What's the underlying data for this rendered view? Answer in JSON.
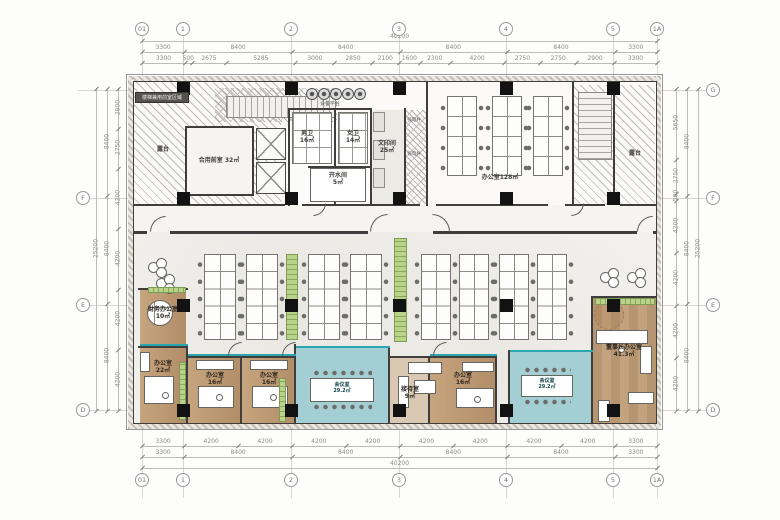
{
  "grid": {
    "top_labels": [
      "01",
      "1",
      "2",
      "3",
      "4",
      "5",
      "1A"
    ],
    "bottom_labels": [
      "01",
      "1",
      "2",
      "3",
      "4",
      "5",
      "1A"
    ],
    "left_labels": [
      "F",
      "E",
      "D"
    ],
    "right_labels": [
      "G",
      "F",
      "E",
      "D"
    ]
  },
  "dims": {
    "top_total": "40200",
    "top_major": [
      "3300",
      "8400",
      "8400",
      "8400",
      "8400",
      "3300"
    ],
    "top_minor": [
      "3300",
      "500",
      "2675",
      "5285",
      "3000",
      "2850",
      "2100",
      "1600",
      "2300",
      "4200",
      "2750",
      "2750",
      "2900",
      "3300"
    ],
    "bottom_minor": [
      "3300",
      "4200",
      "4200",
      "4200",
      "4200",
      "4200",
      "4200",
      "4200",
      "4200",
      "3300"
    ],
    "bottom_major": [
      "3300",
      "8400",
      "8400",
      "8400",
      "8400",
      "3300"
    ],
    "bottom_total": "40200",
    "left_inner": [
      "2800",
      "2750",
      "4200",
      "4200",
      "4200",
      "4200"
    ],
    "left_major": [
      "8400",
      "8400",
      "8400"
    ],
    "left_total": "25200",
    "right_inner": [
      "5650",
      "2750",
      "500",
      "4200",
      "4200",
      "4200",
      "4200"
    ],
    "right_major": [
      "8400",
      "8400",
      "8400"
    ],
    "right_total": "25200"
  },
  "rooms": {
    "stair_note": "楼梯兼用前室区域",
    "terrace_left": "露台",
    "terrace_right": "露台",
    "vestibule": "合用前室  32㎡",
    "mens_toilet": "男卫\n16㎡",
    "womens_toilet": "女卫\n14㎡",
    "hot_water": "开水间\n5㎡",
    "equipment_platform": "设备平台",
    "print_room": "文印间\n25㎡",
    "shaft_strong": "强电井",
    "shaft_weak": "弱电井",
    "office_top": "办公室128㎡",
    "finance_office": "财务办公室\n10㎡",
    "office_22": "办公室\n22㎡",
    "office_16_a": "办公室\n16㎡",
    "office_16_b": "办公室\n16㎡",
    "meeting_a": "会议室\n29.2㎡",
    "reception": "接待室\n9㎡",
    "office_16_c": "办公室\n16㎡",
    "meeting_b": "会议室\n29.2㎡",
    "chairman": "董事长办公室\n41.3㎡"
  },
  "colors": {
    "wood": "#c3a17d",
    "teal_room": "#a3ced4",
    "glass": "#2ba6b0",
    "planter": "#b9d38b",
    "wall": "#3f3e3c",
    "column": "#121212",
    "dim_text": "#8d8c8a"
  }
}
